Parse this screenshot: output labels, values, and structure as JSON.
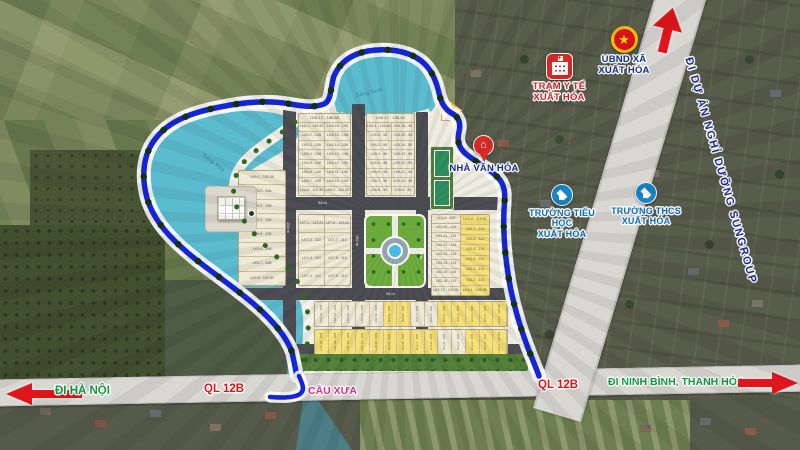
{
  "pois": [
    {
      "id": "tram-y-te",
      "icon": "hospital-icon",
      "lines": [
        "TRẠM Y TẾ",
        "XUẤT HÓA"
      ],
      "color": "#d6252b"
    },
    {
      "id": "ubnd",
      "icon": "national-emblem-icon",
      "lines": [
        "UBND XÃ",
        "XUẤT HÓA"
      ],
      "color": "#15308a"
    },
    {
      "id": "nha-van-hoa",
      "icon": "pin-home-icon",
      "lines": [
        "NHÀ VĂN HÓA"
      ],
      "color": "#15308a"
    },
    {
      "id": "truong-tieu-hoc",
      "icon": "graduation-icon",
      "lines": [
        "TRƯỜNG TIỂU HỌC",
        "XUẤT HÓA"
      ],
      "color": "#0d6fb8"
    },
    {
      "id": "truong-thcs",
      "icon": "graduation-icon",
      "lines": [
        "TRƯỜNG THCS",
        "XUẤT HÓA"
      ],
      "color": "#0d6fb8"
    }
  ],
  "road_labels": {
    "di_ha_noi": "ĐI HÀ NỘI",
    "ql12b_left": "QL 12B",
    "cau_xua": "CẦU XƯA",
    "ql12b_right": "QL 12B",
    "di_ninh_binh": "ĐI NINH BÌNH, THANH HÓA",
    "sungroup": "ĐI DỰ ÁN NGHỈ DƯỠNG SUNGROUP"
  },
  "water_labels": [
    "Sông Xưa",
    "Sông Xưa"
  ],
  "dimension_labels": [
    "154 m",
    "152 m",
    "152 m",
    "94 m",
    "12.5 m",
    "34 m"
  ],
  "colors": {
    "boundary_blue": "#1526d8",
    "lake": "#5cbccf",
    "lot_cream": "#efe9d6",
    "lot_yellow": "#f6e178",
    "label_green": "#179b3f",
    "label_red": "#e0161c",
    "label_pink": "#d6368f",
    "label_navy": "#1b2c96"
  },
  "blocks": [
    {
      "name": "LK8",
      "header": "LK8-17 - 186.88",
      "columns": [
        [
          "LK8-1 - 145.92",
          "LK8-2 - 108",
          "LK8-3 - 108",
          "LK8-4 - 108",
          "LK8-5 - 108",
          "LK8-6 - 108",
          "LK8-7 - 108",
          "LK8-8 - 102.50"
        ],
        [
          "LK8-16 - 108",
          "LK8-15 - 108",
          "LK8-14 - 108",
          "LK8-13 - 108",
          "LK8-12 - 108",
          "LK8-11 - 108",
          "LK8-10 - 108",
          "LK8-9 - 102.50"
        ]
      ],
      "yellow": [
        false,
        false
      ]
    },
    {
      "name": "LK6",
      "header": "LK6-17 - 158.40",
      "columns": [
        [
          "LK6-1 - 120.66",
          "LK6-2 - 96",
          "LK6-3 - 96",
          "LK6-4 - 96",
          "LK6-5 - 96",
          "LK6-6 - 96",
          "LK6-7 - 96",
          "LK6-8 - 96"
        ],
        [
          "LK6-16 - 96",
          "LK6-15 - 96",
          "LK6-14 - 96",
          "LK6-13 - 96",
          "LK6-12 - 96",
          "LK6-11 - 96",
          "LK6-10 - 96",
          "LK6-9 - 96"
        ]
      ],
      "yellow": [
        false,
        false
      ]
    },
    {
      "name": "LK9",
      "header": "",
      "columns": [
        [
          "LK9-1 - 102.50",
          "LK9-2 - 108",
          "LK9-3 - 108",
          "LK9-4 - 108",
          "LK9-5 - 108",
          "LK9-6 - 108",
          "LK9-7 - 108",
          "LK9-8 - 143.81"
        ]
      ],
      "yellow": [
        false
      ]
    },
    {
      "name": "LK7",
      "header": "",
      "columns": [
        [
          "LK7-1 - 143.81",
          "LK7-2 - 110",
          "LK7-3 - 110",
          "LK7-4 - 110"
        ],
        [
          "LK7-8 - 143.81",
          "LK7-7 - 110",
          "LK7-6 - 110",
          "LK7-5 - 110"
        ]
      ],
      "yellow": [
        false,
        false
      ]
    },
    {
      "name": "LK3",
      "header": "",
      "columns": [
        [
          "LK3-9 - 102",
          "LK3-10 - 114",
          "LK3-11 - 114",
          "LK3-12 - 114",
          "LK3-13 - 114",
          "LK3-14 - 114",
          "LK3-15 - 114",
          "LK3-16 - 114",
          "LK3-17 - 120.82"
        ],
        [
          "LK3-8 - 115.61",
          "LK3-7 - 114",
          "LK3-6 - 114",
          "LK3-5 - 114",
          "LK3-4 - 114",
          "LK3-3 - 114",
          "LK3-2 - 114",
          "LK3-1 - 109.88"
        ]
      ],
      "yellow": [
        false,
        true
      ]
    },
    {
      "name": "LK2",
      "row": true,
      "lots": [
        "LK2-14 - 108",
        "LK2-13 - 108",
        "LK2-12 - 108",
        "LK2-11 - 108",
        "LK2-10 - 108",
        "LK2-9 - 108",
        "LK2-8 - 108",
        "LK2-7 - 108",
        "LK2-6 - 108",
        "LK2-5 - 108",
        "LK2-4 - 108",
        "LK2-3 - 108",
        "LK2-2 - 108",
        "LK2-1 - 121.50"
      ],
      "yellow_lots": [
        false,
        false,
        false,
        false,
        false,
        true,
        true,
        false,
        false,
        true,
        true,
        true,
        true,
        true
      ]
    },
    {
      "name": "LK1",
      "row": true,
      "lots": [
        "LK1-14 - 108",
        "LK1-13 - 108",
        "LK1-12 - 108",
        "LK1-11 - 108",
        "LK1-10 - 108",
        "LK1-9 - 108",
        "LK1-8 - 108",
        "LK1-7 - 108",
        "LK1-6 - 108",
        "LK1-5 - 108",
        "LK1-4 - 108",
        "LK1-3 - 108",
        "LK1-2 - 108",
        "LK1-1 - 121.50"
      ],
      "yellow_lots": [
        true,
        true,
        true,
        true,
        true,
        true,
        true,
        true,
        true,
        false,
        false,
        true,
        true,
        true
      ]
    }
  ]
}
